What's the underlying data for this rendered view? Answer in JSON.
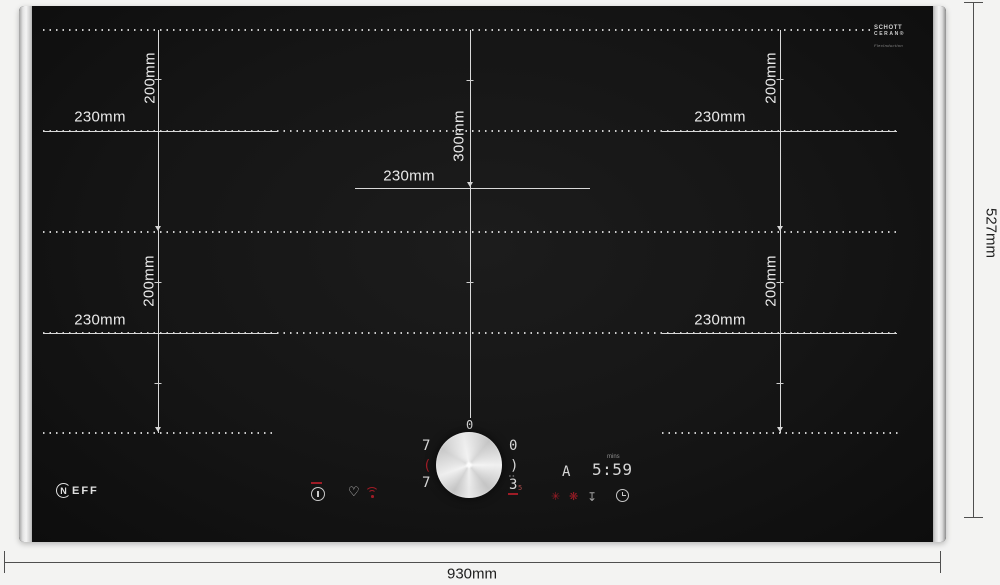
{
  "product": {
    "brand_n": "N",
    "brand_suffix": "EFF",
    "glass_brand_line1": "SCHOTT",
    "glass_brand_line2": "CERAN®",
    "glass_brand_line3": "FlexInduction"
  },
  "dimensions": {
    "overall_width": "930mm",
    "overall_height": "527mm",
    "zones": [
      {
        "id": "top-left",
        "width": "230mm",
        "height": "200mm"
      },
      {
        "id": "bottom-left",
        "width": "230mm",
        "height": "200mm"
      },
      {
        "id": "center",
        "width": "230mm",
        "height": "300mm"
      },
      {
        "id": "top-right",
        "width": "230mm",
        "height": "200mm"
      },
      {
        "id": "bottom-right",
        "width": "230mm",
        "height": "200mm"
      }
    ]
  },
  "control_panel": {
    "display_left": {
      "top": "7",
      "mid": "(",
      "bottom": "7"
    },
    "display_small_top": "0",
    "display_right": {
      "top": "0",
      "mid": ")",
      "hi": "▸▸",
      "power": "3",
      "power_suffix": "5"
    },
    "zone_indicator": "A",
    "timer": {
      "value": "5:59",
      "unit": "mins"
    },
    "glyphs": {
      "heart": "♡",
      "clean": "✳",
      "fan": "❋",
      "pan": "↧"
    }
  },
  "colors": {
    "accent_red": "#9e1c26",
    "glass": "#151515",
    "digit": "#d6d6d6",
    "zone_line": "#d9d9d9",
    "outer_line": "#4f4f4f"
  }
}
